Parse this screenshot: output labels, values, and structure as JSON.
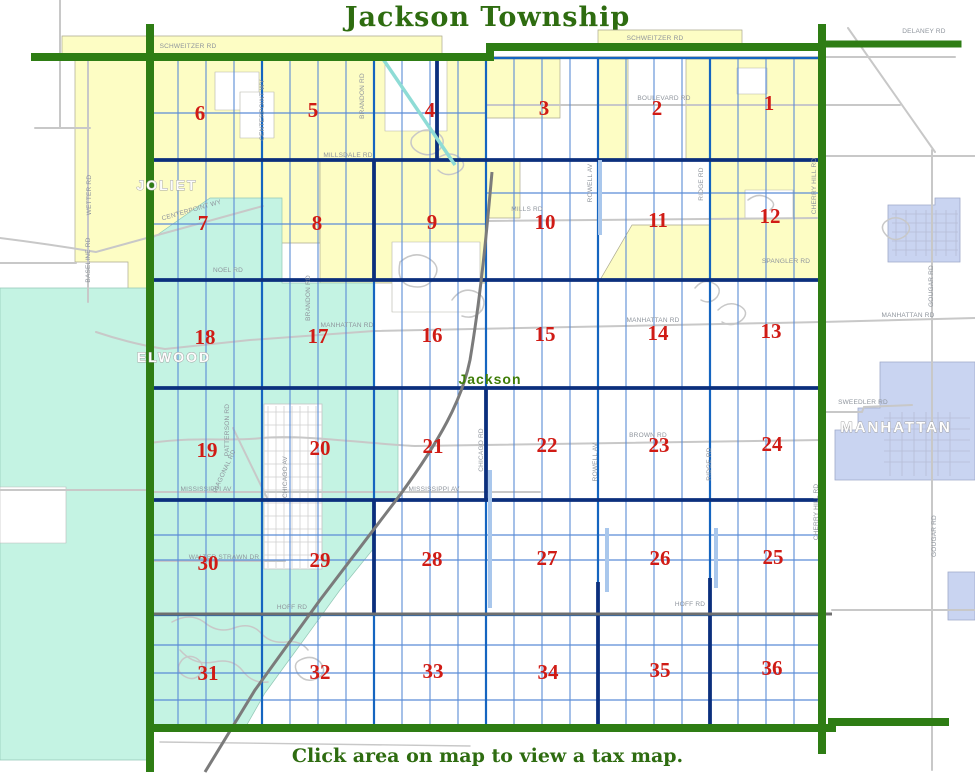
{
  "title": "Jackson Township",
  "caption": "Click area on map to view a tax map.",
  "colors": {
    "title_green": "#2e6c10",
    "boundary": "#2e7d14",
    "joliet": "#fdfdc4",
    "elwood": "#c4f3e3",
    "manhattan": "#c9d4f1",
    "grid_blue": "#1565c0",
    "grid_navy": "#0b2f7d",
    "grid_thin": "#5b8cd6",
    "grid_wide_lt": "#a9c7ec",
    "road_gray": "#c8c8c8",
    "road_dark": "#6f6f6f",
    "rail_gray": "#7b7b7b",
    "canal": "#8edcd6",
    "section_red": "#d01b15",
    "label_gray": "#8e949c",
    "city_white": "#fdfdfd",
    "city_halo": "#a2a2a2",
    "place_green": "#3f7d08"
  },
  "sections": [
    {
      "num": "6",
      "x": 200,
      "y": 113
    },
    {
      "num": "5",
      "x": 313,
      "y": 110
    },
    {
      "num": "4",
      "x": 430,
      "y": 110
    },
    {
      "num": "3",
      "x": 544,
      "y": 108
    },
    {
      "num": "2",
      "x": 657,
      "y": 108
    },
    {
      "num": "1",
      "x": 769,
      "y": 103
    },
    {
      "num": "7",
      "x": 203,
      "y": 223
    },
    {
      "num": "8",
      "x": 317,
      "y": 223
    },
    {
      "num": "9",
      "x": 432,
      "y": 222
    },
    {
      "num": "10",
      "x": 545,
      "y": 222
    },
    {
      "num": "11",
      "x": 658,
      "y": 220
    },
    {
      "num": "12",
      "x": 770,
      "y": 216
    },
    {
      "num": "18",
      "x": 205,
      "y": 337
    },
    {
      "num": "17",
      "x": 318,
      "y": 336
    },
    {
      "num": "16",
      "x": 432,
      "y": 335
    },
    {
      "num": "15",
      "x": 545,
      "y": 334
    },
    {
      "num": "14",
      "x": 658,
      "y": 333
    },
    {
      "num": "13",
      "x": 771,
      "y": 331
    },
    {
      "num": "19",
      "x": 207,
      "y": 450
    },
    {
      "num": "20",
      "x": 320,
      "y": 448
    },
    {
      "num": "21",
      "x": 433,
      "y": 446
    },
    {
      "num": "22",
      "x": 547,
      "y": 445
    },
    {
      "num": "23",
      "x": 659,
      "y": 445
    },
    {
      "num": "24",
      "x": 772,
      "y": 444
    },
    {
      "num": "30",
      "x": 208,
      "y": 563
    },
    {
      "num": "29",
      "x": 320,
      "y": 560
    },
    {
      "num": "28",
      "x": 432,
      "y": 559
    },
    {
      "num": "27",
      "x": 547,
      "y": 558
    },
    {
      "num": "26",
      "x": 660,
      "y": 558
    },
    {
      "num": "25",
      "x": 773,
      "y": 557
    },
    {
      "num": "31",
      "x": 208,
      "y": 673
    },
    {
      "num": "32",
      "x": 320,
      "y": 672
    },
    {
      "num": "33",
      "x": 433,
      "y": 671
    },
    {
      "num": "34",
      "x": 548,
      "y": 672
    },
    {
      "num": "35",
      "x": 660,
      "y": 670
    },
    {
      "num": "36",
      "x": 772,
      "y": 668
    }
  ],
  "road_labels": [
    {
      "text": "SCHWEITZER RD",
      "x": 188,
      "y": 48,
      "rot": 0
    },
    {
      "text": "SCHWEITZER RD",
      "x": 655,
      "y": 40,
      "rot": 0
    },
    {
      "text": "DELANEY RD",
      "x": 924,
      "y": 33,
      "rot": 0
    },
    {
      "text": "BOULEVARD RD",
      "x": 664,
      "y": 100,
      "rot": 0
    },
    {
      "text": "MILLSDALE RD",
      "x": 348,
      "y": 157,
      "rot": 0
    },
    {
      "text": "MILLS RD",
      "x": 527,
      "y": 211,
      "rot": 0
    },
    {
      "text": "NOEL RD",
      "x": 228,
      "y": 272,
      "rot": 0
    },
    {
      "text": "SPANGLER RD",
      "x": 786,
      "y": 263,
      "rot": 0
    },
    {
      "text": "MANHATTAN RD",
      "x": 347,
      "y": 327,
      "rot": 0
    },
    {
      "text": "MANHATTAN RD",
      "x": 653,
      "y": 322,
      "rot": 0
    },
    {
      "text": "MANHATTAN RD",
      "x": 908,
      "y": 317,
      "rot": 0
    },
    {
      "text": "SWEEDLER RD",
      "x": 863,
      "y": 404,
      "rot": 0
    },
    {
      "text": "BROWN RD",
      "x": 648,
      "y": 437,
      "rot": 0
    },
    {
      "text": "MISSISSIPPI AV",
      "x": 206,
      "y": 491,
      "rot": 0
    },
    {
      "text": "MISSISSIPPI AV",
      "x": 434,
      "y": 491,
      "rot": 0
    },
    {
      "text": "WALTER STRAWN DR",
      "x": 224,
      "y": 559,
      "rot": 0
    },
    {
      "text": "HOFF RD",
      "x": 292,
      "y": 609,
      "rot": 0
    },
    {
      "text": "HOFF RD",
      "x": 690,
      "y": 606,
      "rot": 0
    },
    {
      "text": "WETTER RD",
      "x": 91,
      "y": 195,
      "rot": -90
    },
    {
      "text": "BASELINE RD",
      "x": 90,
      "y": 260,
      "rot": -90
    },
    {
      "text": "CENTERPOINT WY",
      "x": 192,
      "y": 212,
      "rot": -16
    },
    {
      "text": "CENTERPOINT WY",
      "x": 264,
      "y": 110,
      "rot": -90
    },
    {
      "text": "BRANDON RD",
      "x": 364,
      "y": 96,
      "rot": -90
    },
    {
      "text": "BRANDON RD",
      "x": 310,
      "y": 298,
      "rot": -90
    },
    {
      "text": "PATTERSON RD",
      "x": 229,
      "y": 430,
      "rot": -90
    },
    {
      "text": "DIAGONAL RD",
      "x": 226,
      "y": 472,
      "rot": -65
    },
    {
      "text": "CHICAGO AV",
      "x": 287,
      "y": 477,
      "rot": -90
    },
    {
      "text": "CHICAGO RD",
      "x": 483,
      "y": 450,
      "rot": -90
    },
    {
      "text": "ROWELL AV",
      "x": 592,
      "y": 183,
      "rot": -90
    },
    {
      "text": "ROWELL AV",
      "x": 597,
      "y": 462,
      "rot": -90
    },
    {
      "text": "RIDGE RD",
      "x": 703,
      "y": 184,
      "rot": -90
    },
    {
      "text": "RIDGE RD",
      "x": 711,
      "y": 464,
      "rot": -90
    },
    {
      "text": "CHERRY HILL RD",
      "x": 816,
      "y": 186,
      "rot": -90
    },
    {
      "text": "CHERRY HILL RD",
      "x": 818,
      "y": 512,
      "rot": -90
    },
    {
      "text": "GOUGAR RD",
      "x": 933,
      "y": 286,
      "rot": -90
    },
    {
      "text": "GOUGAR RD",
      "x": 936,
      "y": 536,
      "rot": -90
    }
  ],
  "city_labels": [
    {
      "text": "JOLIET",
      "x": 167,
      "y": 190,
      "size": 14,
      "kind": "city"
    },
    {
      "text": "ELWOOD",
      "x": 174,
      "y": 362,
      "size": 14,
      "kind": "city"
    },
    {
      "text": "MANHATTAN",
      "x": 896,
      "y": 432,
      "size": 15,
      "kind": "city"
    },
    {
      "text": "Jackson",
      "x": 490,
      "y": 384,
      "size": 14,
      "kind": "place"
    }
  ]
}
